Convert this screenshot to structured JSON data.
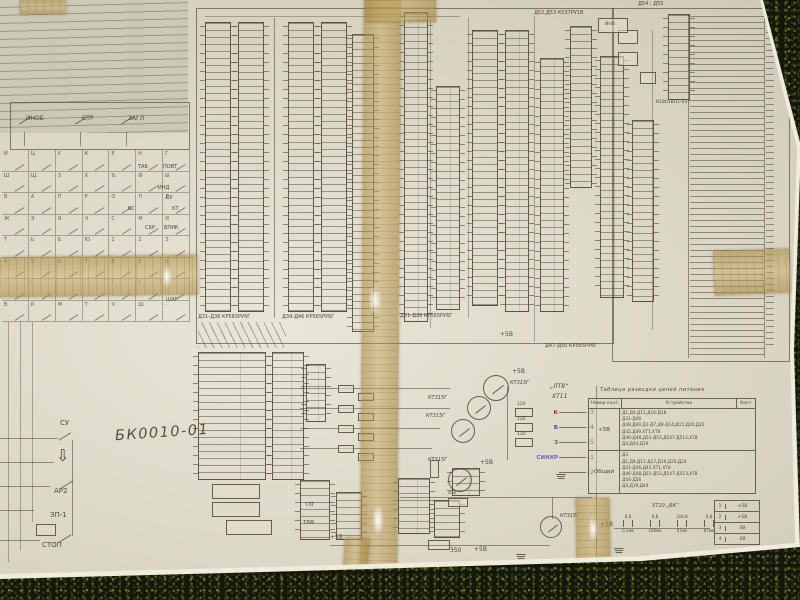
{
  "colors": {
    "paper": "#d9d4c2",
    "ink": "#4e4639",
    "tape": "#c0a060",
    "grass": "#15170d",
    "red": "#a03a2a",
    "blue": "#3a55a0",
    "green": "#41794a",
    "violet": "#6a63b5"
  },
  "handwritten_title": "БК0010-01",
  "keyboard": {
    "mode_switches": [
      "ИНОБ",
      "СТР",
      "ЗАГЛ"
    ],
    "matrix_keys": [
      "Й",
      "Ц",
      "У",
      "К",
      "Е",
      "Н",
      "Г",
      "Ш",
      "Щ",
      "З",
      "Х",
      "Ъ",
      "Ф",
      "Ы",
      "В",
      "А",
      "П",
      "Р",
      "О",
      "Л",
      "Д",
      "Ж",
      "Э",
      "Я",
      "Ч",
      "С",
      "М",
      "И",
      "Т",
      "Ь",
      "Б",
      "Ю",
      "1",
      "2",
      "3",
      "4",
      "5",
      "6",
      "7",
      "8",
      "9",
      "0",
      "-",
      ":",
      ",",
      ".",
      ";",
      "(",
      ")",
      "В",
      "К",
      "М",
      "Т",
      "Ч",
      "Ш",
      "·"
    ],
    "side_labels": [
      "ТАБ",
      "ПОВТ",
      "ИНД",
      "СУ",
      "ВС",
      "КТ",
      "СБР",
      "ВПИК",
      "ШАГ"
    ],
    "special_keys": [
      "СУ",
      "⇩",
      "АР2",
      "ЗП-1",
      "СТОП"
    ]
  },
  "ics": {
    "captions": [
      "Д31-Д38 КР565РУ6Г",
      "Д39-Д46 КР565РУ6Г",
      "Д21-Д28 КР565РУ6Г",
      "Д47-Д50 КР565РУ6Г",
      "Д52,Д53 К537РУ1В",
      "Д54 ; Д55",
      "К1801ВП1-037",
      "ИНВ"
    ]
  },
  "analog": {
    "transistor_label": "КТ315Г",
    "power_label": "+5В",
    "r120": "120",
    "r43k": "43к",
    "r350": "350",
    "audio_labels": [
      "ТЛГ",
      "ТЛФ"
    ],
    "video_connector": {
      "name": "„ЛТ8“",
      "designator": "ХТ11",
      "pins": [
        {
          "signal": "К",
          "pin": "3",
          "color": "#a03a2a"
        },
        {
          "signal": "В",
          "pin": "4",
          "color": "#3a55a0"
        },
        {
          "signal": "З",
          "pin": "5",
          "color": "#41794a"
        },
        {
          "signal": "СИНХР",
          "pin": "1",
          "color": "#6a63b5"
        },
        {
          "signal": "",
          "pin": "2",
          "color": "#4e4639"
        }
      ]
    }
  },
  "power_table": {
    "title": "Таблица разводки цепей питания",
    "col_headers": [
      "Номер конт.",
      "Устройство",
      "Конт"
    ],
    "rows": [
      {
        "net": "+5В",
        "devices": [
          "Д1,Д9,Д11,Д16-Д18",
          "Д31-Д46",
          "Д48,Д49,Д1-Д7,Д9-Д14,Д15,Д20,Д22",
          "Д42,Д49,ХТ1,ХТ8",
          "Д46-Д48,Д51-Д53,Д547-Д513,ХТ8",
          "Д4,Д44,Д19"
        ]
      },
      {
        "net": "Общий",
        "devices": [
          "Д3",
          "Д1,Д9,Д11-Д17,Д19,Д20,Д24",
          "Д31-Д46,Д42,ХТ1,ХТ8",
          "Д46-Д48,Д51-Д53,Д547-Д513,ХТ8",
          "Д54-Д56",
          "Д4,Д19,Д44"
        ]
      }
    ]
  },
  "aux": {
    "connector_label": "ХТ10 „БК“",
    "power_label": "+5В",
    "caps": [
      {
        "v": "6,8",
        "sub": "0,1мк"
      },
      {
        "v": "6,8",
        "sub": "100мк"
      },
      {
        "v": "2х6,8",
        "sub": "47мк"
      },
      {
        "v": "6,8",
        "sub": "67мк"
      }
    ],
    "mini_table": [
      {
        "pin": "1",
        "net": "+5В"
      },
      {
        "pin": "2",
        "net": "+5В"
      },
      {
        "pin": "3",
        "net": "0В"
      },
      {
        "pin": "4",
        "net": "0В"
      }
    ]
  }
}
